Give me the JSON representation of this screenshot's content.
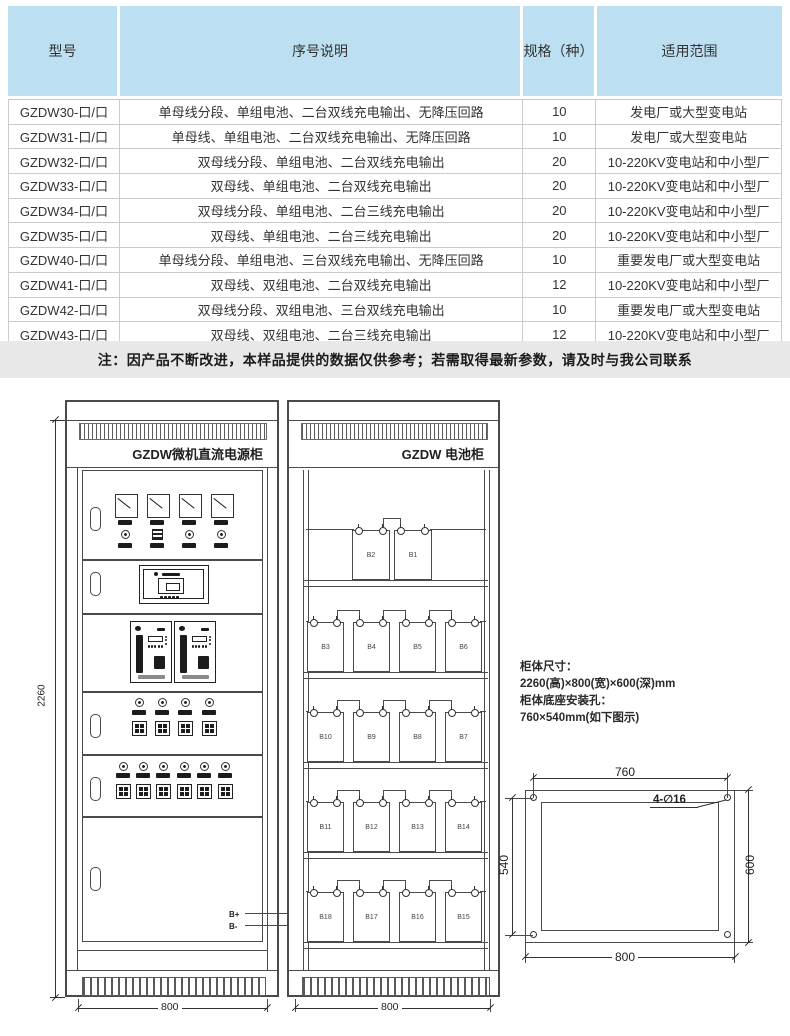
{
  "table": {
    "headers": [
      "型号",
      "序号说明",
      "规格（种）",
      "适用范围"
    ],
    "rows": [
      [
        "GZDW30-口/口",
        "单母线分段、单组电池、二台双线充电输出、无降压回路",
        "10",
        "发电厂或大型变电站"
      ],
      [
        "GZDW31-口/口",
        "单母线、单组电池、二台双线充电输出、无降压回路",
        "10",
        "发电厂或大型变电站"
      ],
      [
        "GZDW32-口/口",
        "双母线分段、单组电池、二台双线充电输出",
        "20",
        "10-220KV变电站和中小型厂"
      ],
      [
        "GZDW33-口/口",
        "双母线、单组电池、二台双线充电输出",
        "20",
        "10-220KV变电站和中小型厂"
      ],
      [
        "GZDW34-口/口",
        "双母线分段、单组电池、二台三线充电输出",
        "20",
        "10-220KV变电站和中小型厂"
      ],
      [
        "GZDW35-口/口",
        "双母线、单组电池、二台三线充电输出",
        "20",
        "10-220KV变电站和中小型厂"
      ],
      [
        "GZDW40-口/口",
        "单母线分段、单组电池、三台双线充电输出、无降压回路",
        "10",
        "重要发电厂或大型变电站"
      ],
      [
        "GZDW41-口/口",
        "双母线、双组电池、二台双线充电输出",
        "12",
        "10-220KV变电站和中小型厂"
      ],
      [
        "GZDW42-口/口",
        "双母线分段、双组电池、三台双线充电输出",
        "10",
        "重要发电厂或大型变电站"
      ],
      [
        "GZDW43-口/口",
        "双母线、双组电池、二台三线充电输出",
        "12",
        "10-220KV变电站和中小型厂"
      ]
    ]
  },
  "note": "注：因产品不断改进，本样品提供的数据仅供参考；若需取得最新参数，请及时与我公司联系",
  "diagram": {
    "left_cabinet": {
      "title": "GZDW微机直流电源柜",
      "width_label": "800",
      "height_label": "2260",
      "bplus": "B+",
      "bminus": "B-"
    },
    "right_cabinet": {
      "title": "GZDW 电池柜",
      "width_label": "800",
      "battery_rows": [
        [
          "B2",
          "B1"
        ],
        [
          "B3",
          "B4",
          "B5",
          "B6"
        ],
        [
          "B10",
          "B9",
          "B8",
          "B7"
        ],
        [
          "B11",
          "B12",
          "B13",
          "B14"
        ],
        [
          "B18",
          "B17",
          "B16",
          "B15"
        ]
      ]
    },
    "info": {
      "line1": "柜体尺寸：",
      "line2": "2260(高)×800(宽)×600(深)mm",
      "line3": "柜体底座安装孔：",
      "line4": "760×540mm(如下图示)"
    },
    "base_plan": {
      "top": "760",
      "left": "540",
      "right": "600",
      "bottom": "800",
      "holes": "4-∅16"
    }
  },
  "colors": {
    "header_bg": "#bcdff1",
    "note_bg": "#e8e8e8",
    "line": "#4a4a4a"
  }
}
